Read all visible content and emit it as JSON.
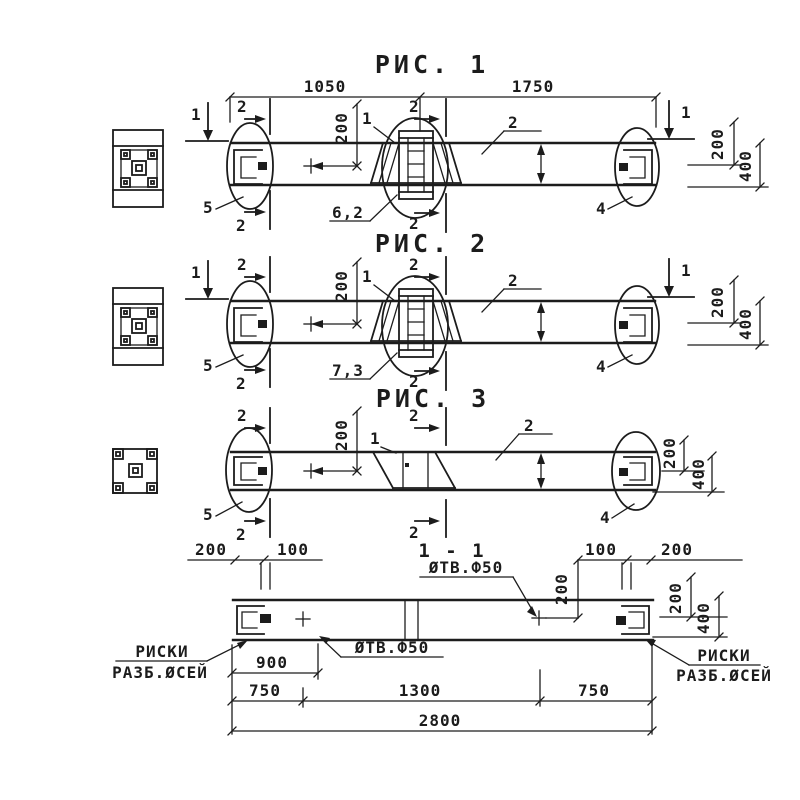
{
  "drawing_type": "structural-beam-detail-sheet",
  "colors": {
    "ink": "#1c1c1c",
    "paper": "#ffffff"
  },
  "figure1": {
    "title": "РИС. 1",
    "dim_left": "1050",
    "dim_right": "1750",
    "weld_label": "6,2"
  },
  "figure2": {
    "title": "РИС. 2",
    "weld_label": "7,3"
  },
  "figure3": {
    "title": "РИС. 3"
  },
  "shared": {
    "section_mark": "1",
    "cut_mark": "2",
    "beam_label": "2",
    "detail_label": "1",
    "left_end_label": "5",
    "right_end_label": "4",
    "dim_200": "200",
    "dim_400": "400"
  },
  "section11": {
    "title": "1 - 1",
    "hole_top": "ØТВ.Ф50",
    "hole_bottom": "ØТВ.Ф50",
    "dim_100": "100",
    "dim_200": "200",
    "dim_400": "400",
    "dim_900": "900",
    "dim_750": "750",
    "dim_1300": "1300",
    "dim_2800": "2800",
    "riski_line1": "РИСКИ",
    "riski_line2": "РАЗБ.ØСЕЙ"
  }
}
